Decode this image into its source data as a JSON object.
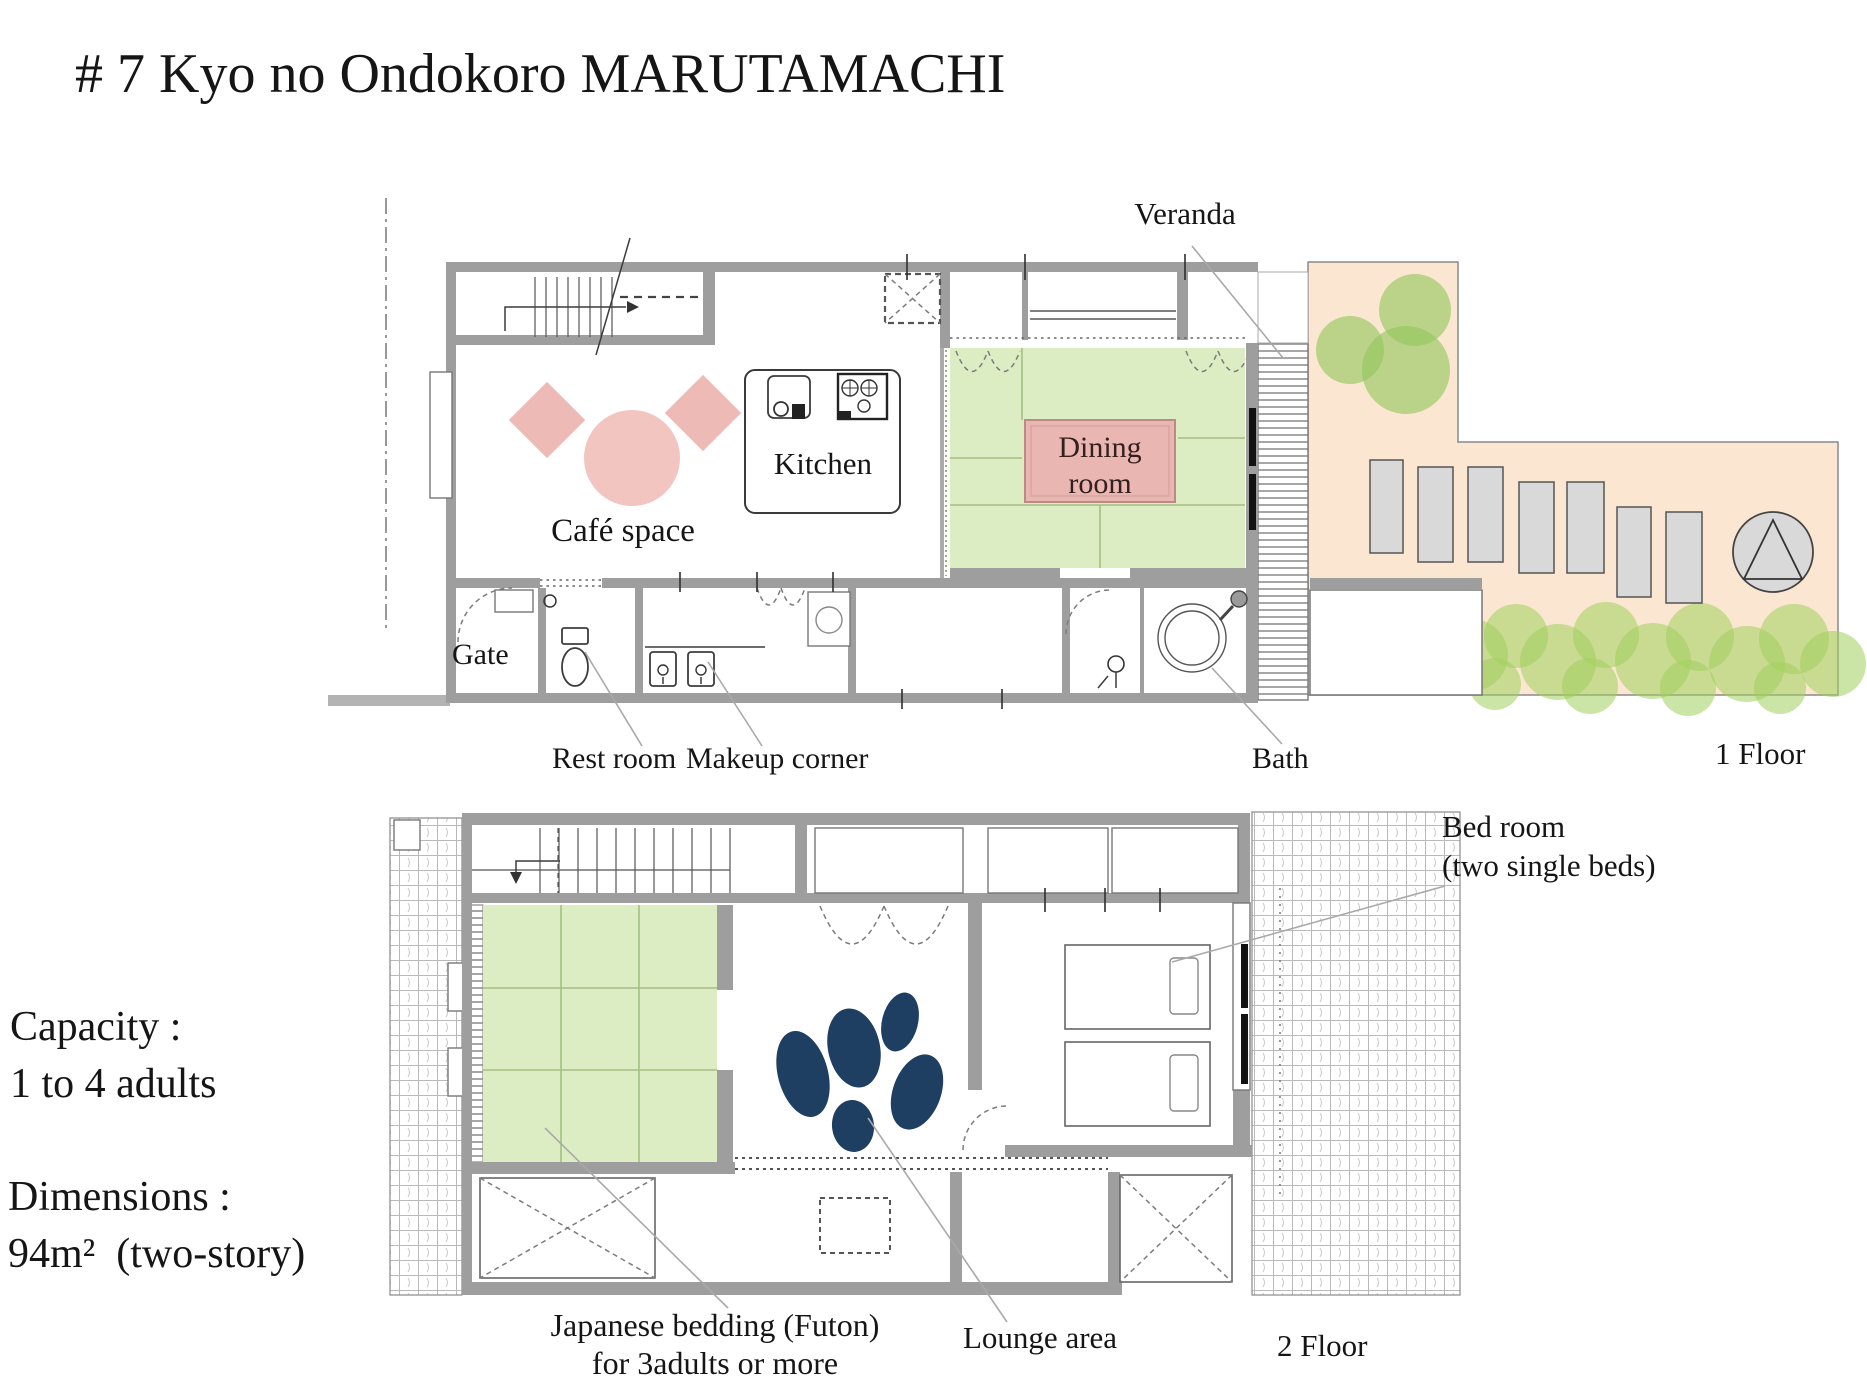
{
  "title": "# 7 Kyo no Ondokoro MARUTAMACHI",
  "floor1": {
    "floor_label": "1 Floor",
    "veranda": "Veranda",
    "cafe": "Café space",
    "kitchen": "Kitchen",
    "dining_line1": "Dining",
    "dining_line2": "room",
    "gate": "Gate",
    "rest_room": "Rest room",
    "makeup_corner": "Makeup corner",
    "bath": "Bath"
  },
  "floor2": {
    "floor_label": "2 Floor",
    "bedroom_line1": "Bed room",
    "bedroom_line2": "(two single beds)",
    "futon_line1": "Japanese bedding (Futon)",
    "futon_line2": "for 3adults or more",
    "lounge": "Lounge area"
  },
  "info": {
    "capacity_label": "Capacity :",
    "capacity_value": "1 to 4 adults",
    "dimensions_label": "Dimensions :",
    "dimensions_value": "94m²  (two-story)"
  },
  "colors": {
    "wall_grey": "#9e9e9e",
    "tatami_green": "#dcecc3",
    "dining_table_pink": "#e9b6b2",
    "cafe_furniture_pink": "#f0c1bc",
    "garden_peach": "#fbe7d1",
    "tree_green": "#92c75a",
    "stepping_stone_grey": "#d9d9d9",
    "beanbag_navy": "#1e3e62",
    "text": "#151515"
  },
  "icons": {
    "stair-icon": "parallel tread lines with direction arrow",
    "toilet-icon": "tank + oval bowl outline",
    "sink-icon": "square basin with tap",
    "stove-icon": "square hob with burner circles",
    "bathtub-icon": "double circle round tub",
    "shower-icon": "shower head with hose",
    "tree-icon": "overlapping green circles",
    "stone-circle-icon": "circle with triangle (garden basin)",
    "closet-x-icon": "rectangle with X diagonals",
    "bed-icon": "rectangle with pillow",
    "beanbag-icon": "navy ellipse cushions"
  }
}
